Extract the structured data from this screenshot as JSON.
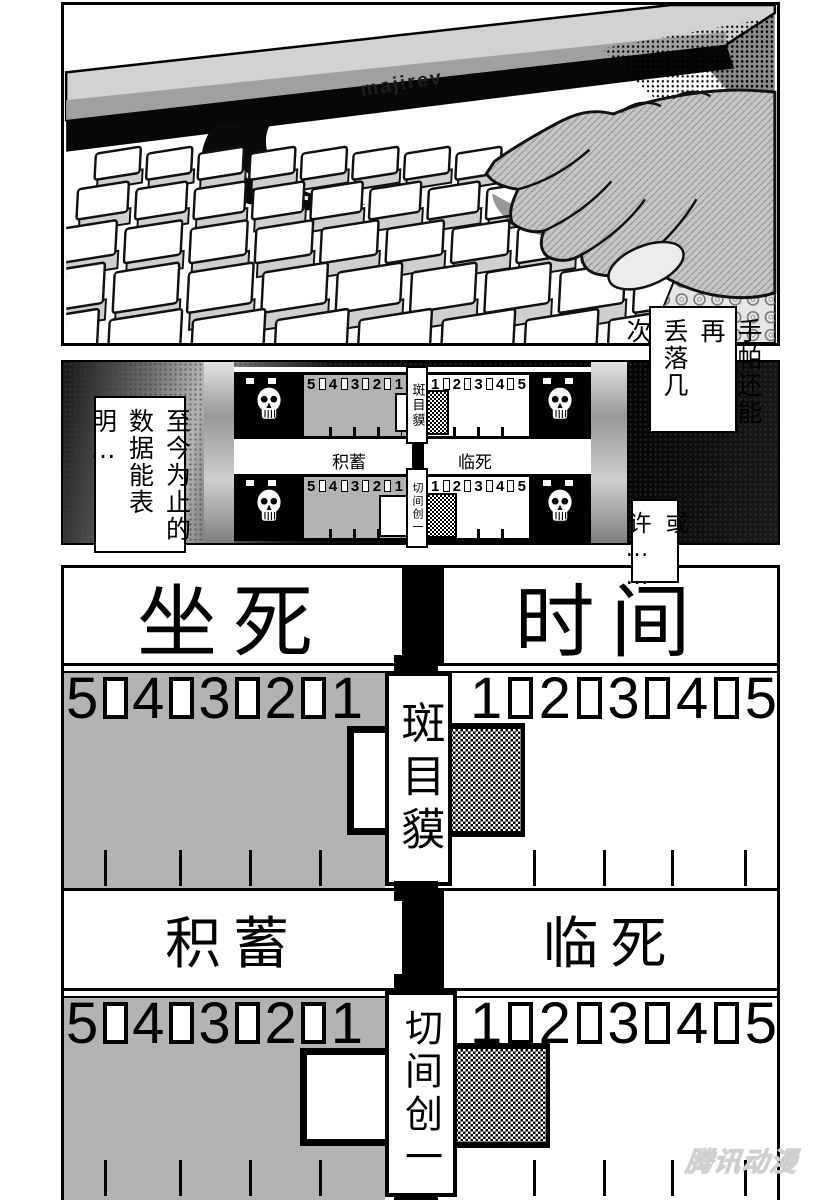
{
  "panel1": {
    "monitor_brand": "majirev"
  },
  "speech": {
    "handkerchief_line1": "手帕还能再",
    "handkerchief_line2": "丢落几次…",
    "data_line1": "至今为止的",
    "data_line2": "数据能表明…",
    "perhaps": "或许……"
  },
  "names": {
    "player1": "斑目貘",
    "player2": "切间创一"
  },
  "labels": {
    "sit_death": "坐死",
    "time": "时间",
    "savings": "积蓄",
    "near_death": "临死"
  },
  "scale": {
    "left": [
      "5",
      "4",
      "3",
      "2",
      "1"
    ],
    "right": [
      "1",
      "2",
      "3",
      "4",
      "5"
    ]
  },
  "watermark": "腾讯动漫",
  "colors": {
    "scale_gray": "#b3b3b3",
    "ink": "#000000",
    "paper": "#ffffff"
  }
}
